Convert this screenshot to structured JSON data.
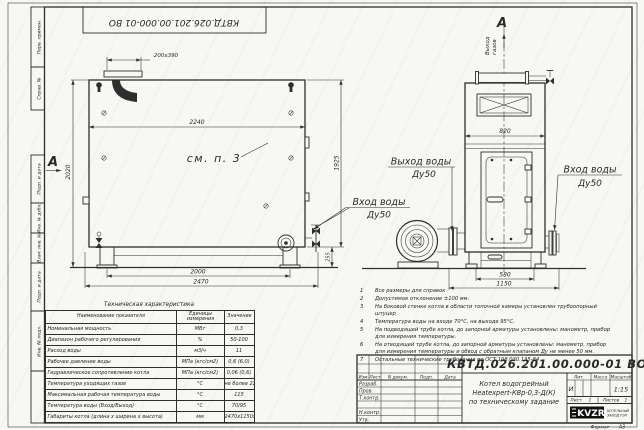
{
  "sheet": {
    "top_stamp": "КВТД.026.201.00.000-01 ВО",
    "format_label": "Формат",
    "format_value": "А3",
    "margin_top": [
      "Перв. примен.",
      "Справ. №"
    ],
    "margin_bottom": [
      "Подп. и дата",
      "Инв. № дубл.",
      "Взам. инв. №",
      "Подп. и дата",
      "Инв. № подл."
    ]
  },
  "side_view": {
    "section_label": "А",
    "flue_dim": "200х390",
    "dim_width_inner": "2240",
    "dim_height_overall": "2020",
    "dim_height_body": "1925",
    "dim_base_height": "255",
    "dim_legs_span": "2000",
    "dim_length_overall": "2470",
    "detail_ref": "см. п. 3",
    "water_in": "Вход воды",
    "water_in_dn": "Ду50"
  },
  "front_view": {
    "section_label": "А",
    "flue_line1": "Выход",
    "flue_line2": "газов",
    "dim_width_top": "820",
    "dim_base": "580",
    "dim_width_overall": "1150",
    "water_out": "Выход воды",
    "water_out_dn": "Ду50",
    "water_in": "Вход воды",
    "water_in_dn": "Ду50"
  },
  "notes": {
    "items": [
      {
        "n": "1",
        "text": "Все размеры для справок"
      },
      {
        "n": "2",
        "text": "Допустимое отклонение ±100 мм."
      },
      {
        "n": "3",
        "text": "На боковой стенке котла в области топочной камеры установлен трубоопорный штуцер"
      },
      {
        "n": "4",
        "text": "Температура воды на входе 70°С, на выходе 95°С."
      },
      {
        "n": "5",
        "text": "На подводящей трубе котла, до запорной арматуры установлены: манометр, прибор для измерения температуры."
      },
      {
        "n": "6",
        "text": "На отводящей трубе котла, до запорной арматуры установлены: манометр, прибор для измерения температуры и обвод с обратным клапаном Ду не менее 50 мм."
      },
      {
        "n": "7",
        "text": "Остальные технические требования по ОСТ 108.030.135-84"
      }
    ]
  },
  "tech_table": {
    "title": "Техническая характеристика",
    "col_name": "Наименование показателя",
    "col_units": "Единицы измерения",
    "col_value": "Значение",
    "rows": [
      [
        "Номинальная мощность",
        "МВт",
        "0,3"
      ],
      [
        "Диапазон рабочего регулирования",
        "%",
        "50-100"
      ],
      [
        "Расход воды",
        "м3/ч",
        "11"
      ],
      [
        "Рабочее давление воды",
        "МПа (кгс/см2)",
        "0,6 (6,0)"
      ],
      [
        "Гидравлическое сопротивление котла",
        "МПа (кгс/см2)",
        "0,06 (0,6)"
      ],
      [
        "Температура уходящих газов",
        "°С",
        "не более 220"
      ],
      [
        "Максимальная рабочая температура воды",
        "°С",
        "115"
      ],
      [
        "Температура воды (Вход/Выход)",
        "°С",
        "70/95"
      ],
      [
        "Габариты котла (длина х ширина х высота)",
        "мм",
        "2470х1150х2020"
      ]
    ]
  },
  "title_block": {
    "doc_number": "КВТД.026.201.00.000-01 ВО",
    "name1": "Котел водогрейный",
    "name2": "Heatexpert-КВр-0,3-Д(К)",
    "name3": "по техническому задание",
    "h_izm": "Изм",
    "h_list": "Лист",
    "h_doc": "N докум.",
    "h_podp": "Подп.",
    "h_data": "Дата",
    "r_razrab": "Разраб.",
    "r_prov": "Пров.",
    "r_tkontr": "Т.контр.",
    "r_nkontr": "Н.контр.",
    "r_utv": "Утв.",
    "lit_label": "Лит.",
    "lit_value": "И",
    "mass_label": "Масса",
    "scale_label": "Масштаб",
    "scale_value": "1:15",
    "sheet_label": "Лист",
    "sheet_value": "1",
    "sheets_label": "Листов",
    "sheets_value": "1",
    "logo": "KVZR",
    "company1": "КОТЕЛЬНЫЙ",
    "company2": "ЗАВОД РЭП"
  }
}
